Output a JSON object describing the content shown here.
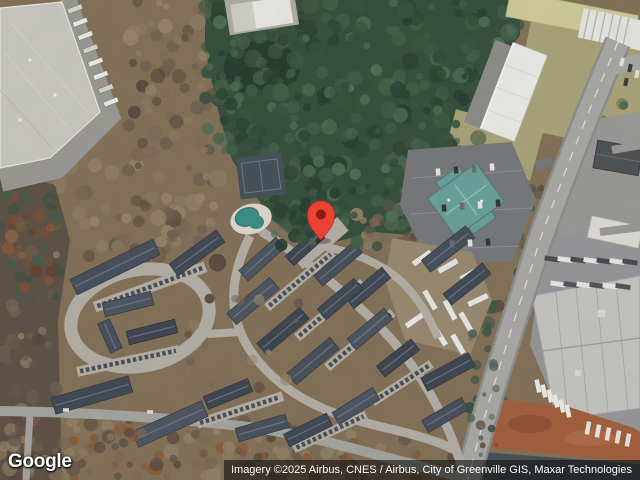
{
  "map": {
    "view": "satellite",
    "logo": "Google",
    "attribution": "Imagery ©2025 Airbus, CNES / Airbus, City of Greenville GIS, Maxar Technologies",
    "marker": {
      "present": true,
      "x": 321,
      "y": 240,
      "body_color": "#EA4335",
      "outline_color": "#B92D21",
      "dot_color": "#8F1B10"
    },
    "palette": {
      "forest": "#37513F",
      "scrub": "#847259",
      "main_road": "#A9A9A7",
      "complex_road": "#B4B0A7",
      "warehouse_roof": "#C9C8C3",
      "apartment_roof": "#48515D",
      "office_roof_teal": "#6BA29A",
      "pool_water": "#3E8F8A",
      "tennis_court": "#47525A",
      "red_clay": "#A3603E",
      "grass_olive": "#A9A47A"
    },
    "features": [
      {
        "name": "warehouse-top-left"
      },
      {
        "name": "forest-top-center"
      },
      {
        "name": "tennis-court"
      },
      {
        "name": "swimming-pool"
      },
      {
        "name": "apartment-complex"
      },
      {
        "name": "teal-roof-office"
      },
      {
        "name": "truck-yard"
      },
      {
        "name": "main-road"
      },
      {
        "name": "industrial-park-bottom-right"
      },
      {
        "name": "red-clay-field"
      },
      {
        "name": "location-marker"
      }
    ]
  }
}
